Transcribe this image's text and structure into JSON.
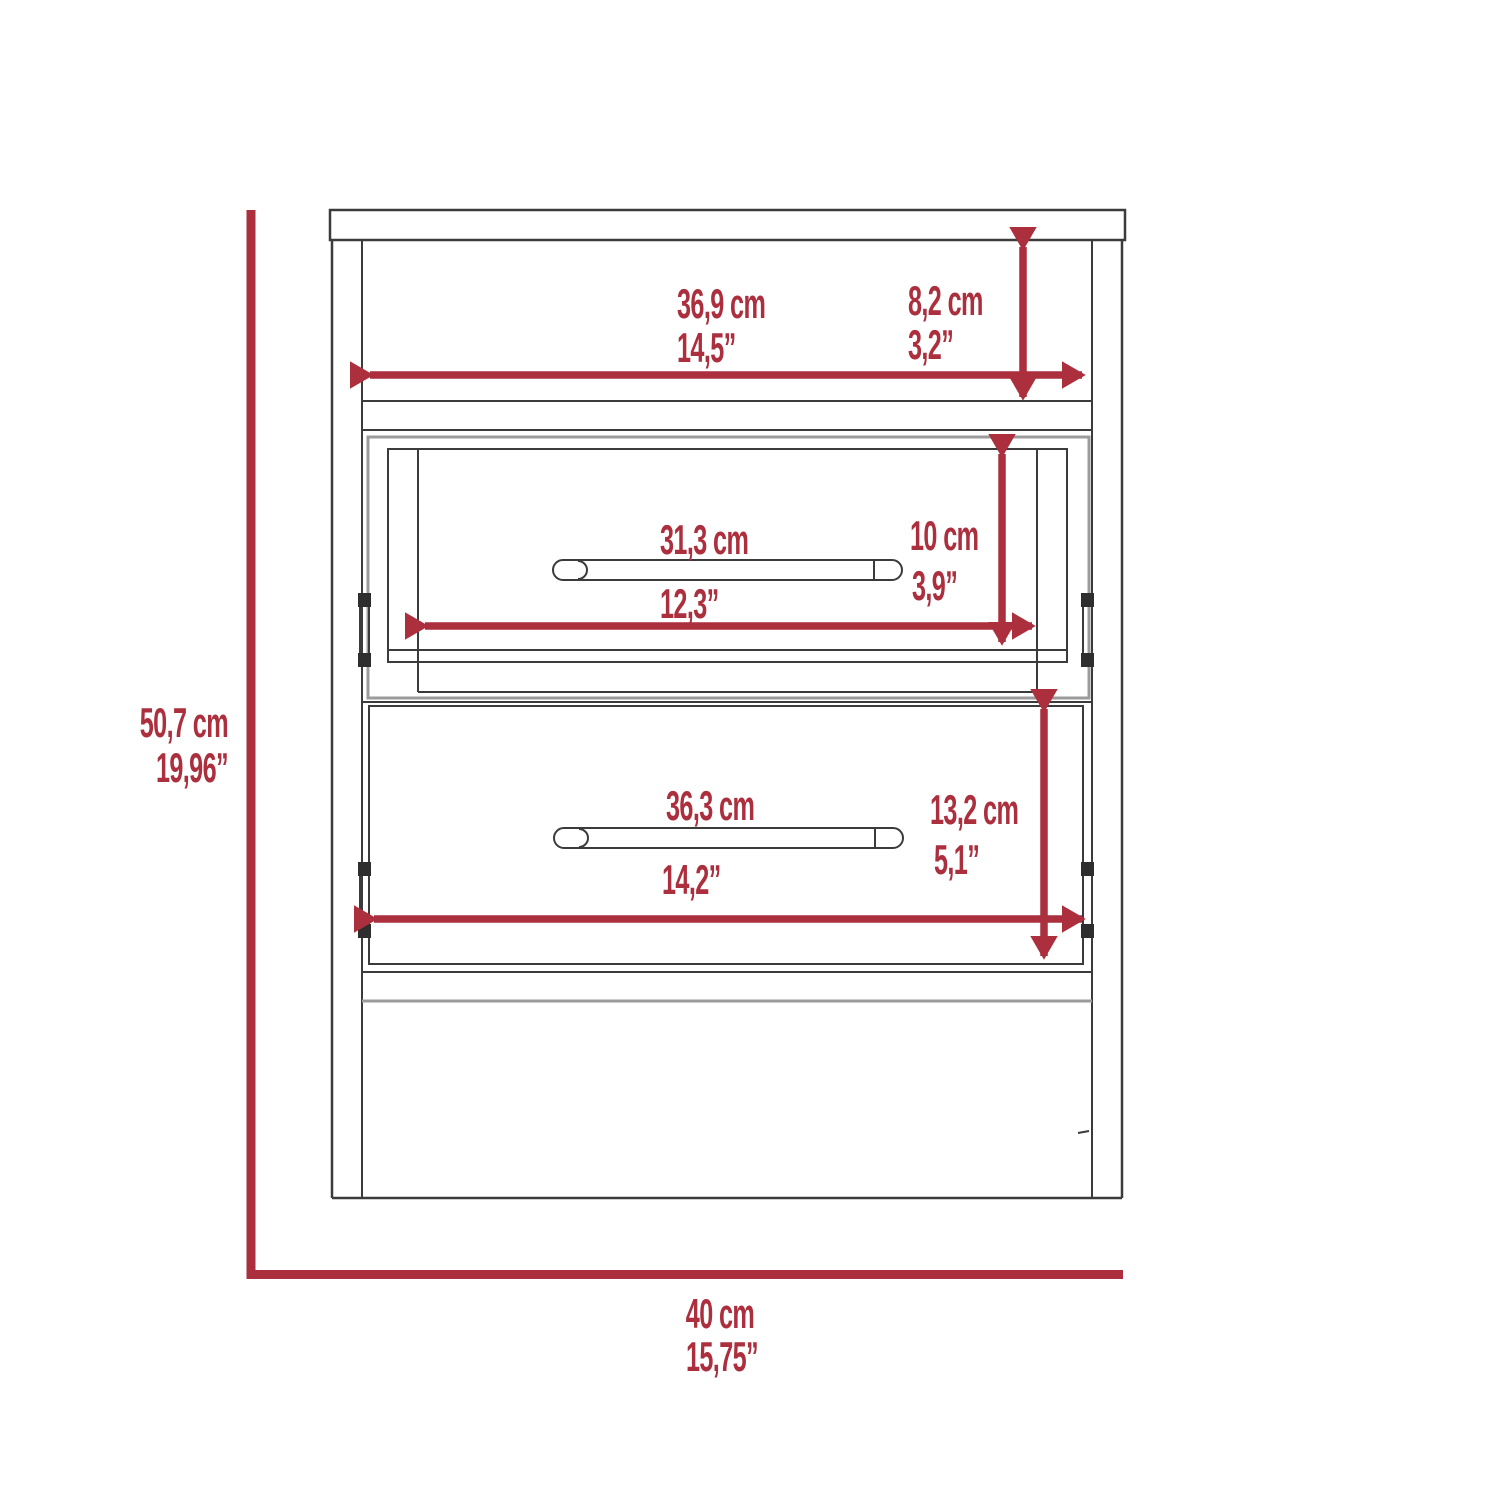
{
  "diagram": {
    "type": "furniture-dimension-diagram",
    "subject": "nightstand front elevation with open shelf and two drawers",
    "accent_color": "#ac2f3e",
    "line_color": "#3b3b3b",
    "dimensions": {
      "overall_height": {
        "cm": "50,7 cm",
        "inches": "19,96”"
      },
      "overall_width": {
        "cm": "40 cm",
        "inches": "15,75”"
      },
      "top_shelf_width": {
        "cm": "36,9 cm",
        "inches": "14,5”"
      },
      "top_shelf_height": {
        "cm": "8,2 cm",
        "inches": "3,2”"
      },
      "middle_drawer_width": {
        "cm": "31,3 cm",
        "inches": "12,3”"
      },
      "middle_drawer_height": {
        "cm": "10 cm",
        "inches": "3,9”"
      },
      "bottom_drawer_width": {
        "cm": "36,3 cm",
        "inches": "14,2”"
      },
      "bottom_drawer_height": {
        "cm": "13,2 cm",
        "inches": "5,1”"
      }
    }
  }
}
